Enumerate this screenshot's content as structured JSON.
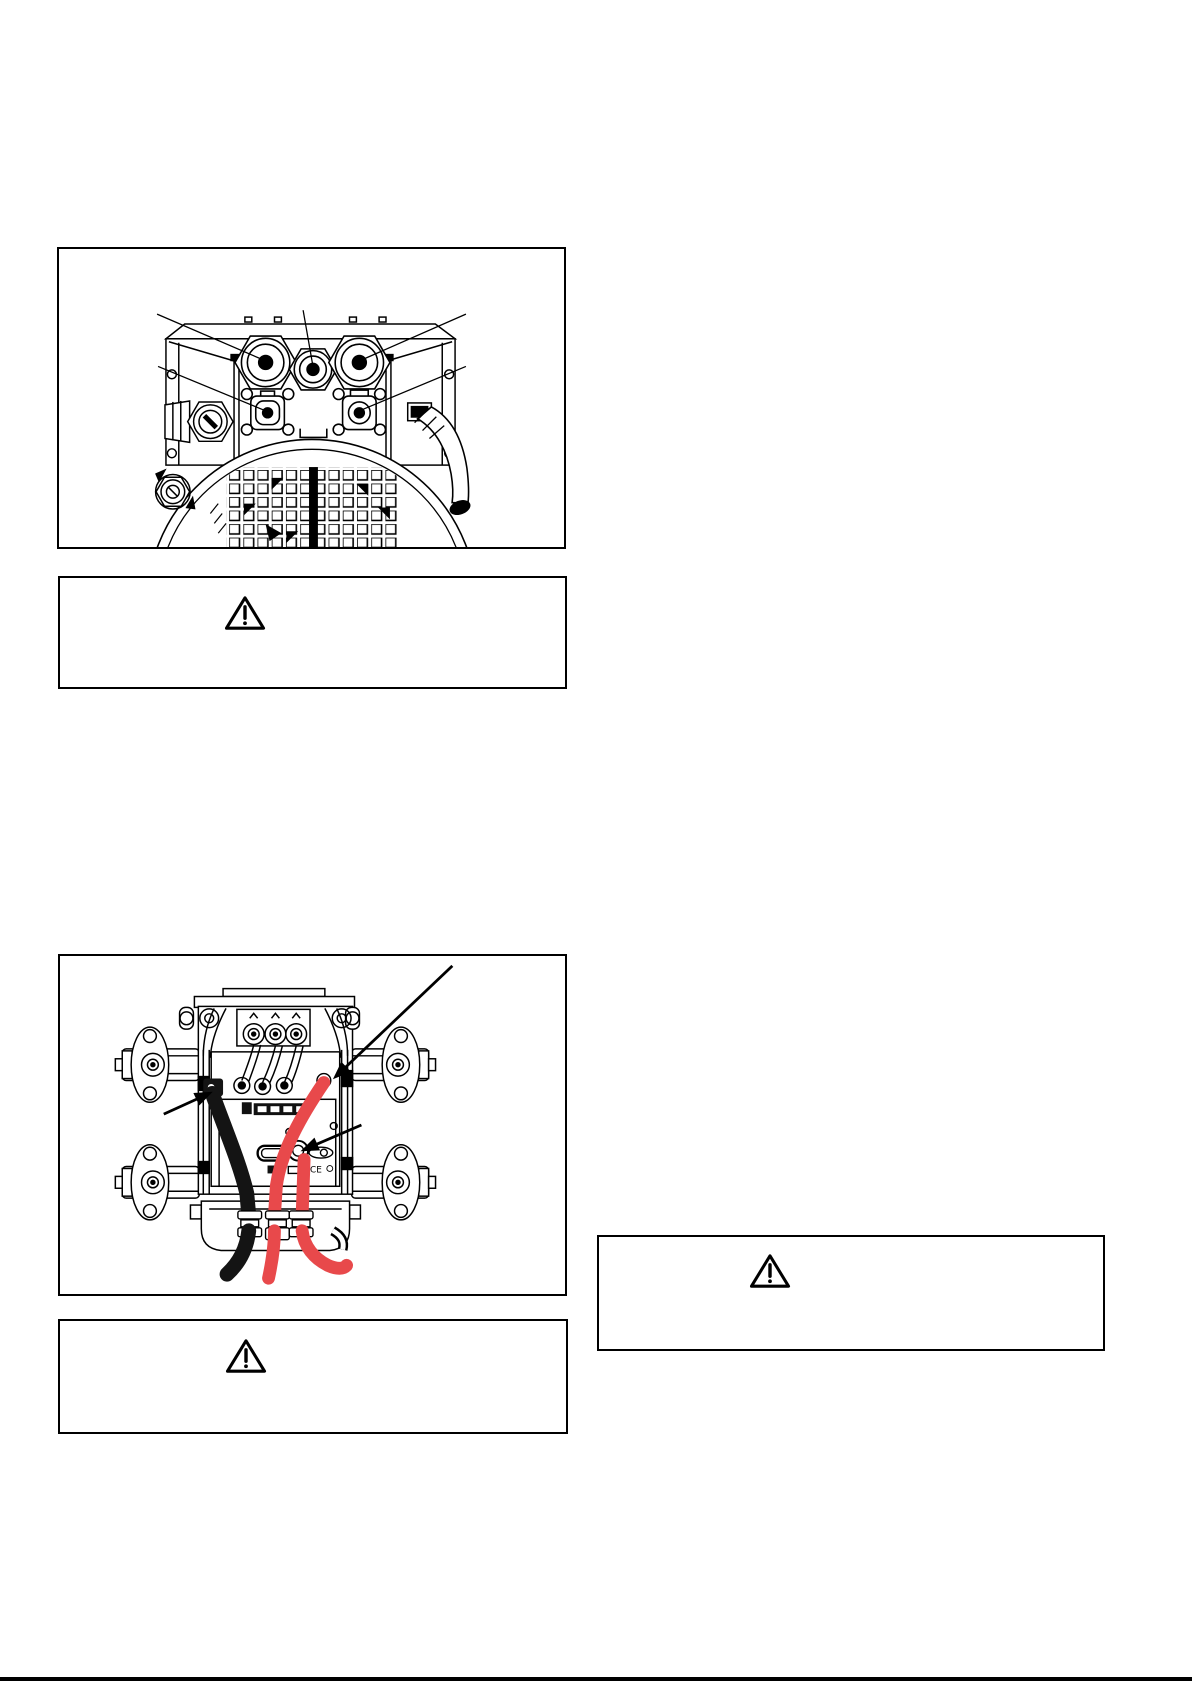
{
  "page": {
    "kind": "instruction-manual-page",
    "width_px": 1192,
    "height_px": 1685,
    "background": "#ffffff"
  },
  "colors": {
    "line_art": "#000000",
    "box_border": "#000000",
    "cable_red": "#e8494b",
    "cable_black": "#141414",
    "footer_rule": "#000000"
  },
  "figures": {
    "connector_view": {
      "name": "rear-connector-panel-figure",
      "drawing": "line-art rear view: three round connectors, two square auxiliary connectors, side fittings, fan grille",
      "leader_lines": 5
    },
    "cable_view": {
      "name": "top-view-cabling-figure",
      "drawing": "line-art top view: unit on four vibration mounts, one black cable and two red cables, three pointer arrows",
      "pointer_arrows": 3,
      "ce_mark": "CE"
    }
  },
  "warnings": [
    {
      "id": "warning-below-connector-figure",
      "icon": "warning-triangle-icon"
    },
    {
      "id": "warning-right-column",
      "icon": "warning-triangle-icon"
    },
    {
      "id": "warning-below-cable-figure",
      "icon": "warning-triangle-icon"
    }
  ],
  "footer": {
    "rule_present": true
  }
}
